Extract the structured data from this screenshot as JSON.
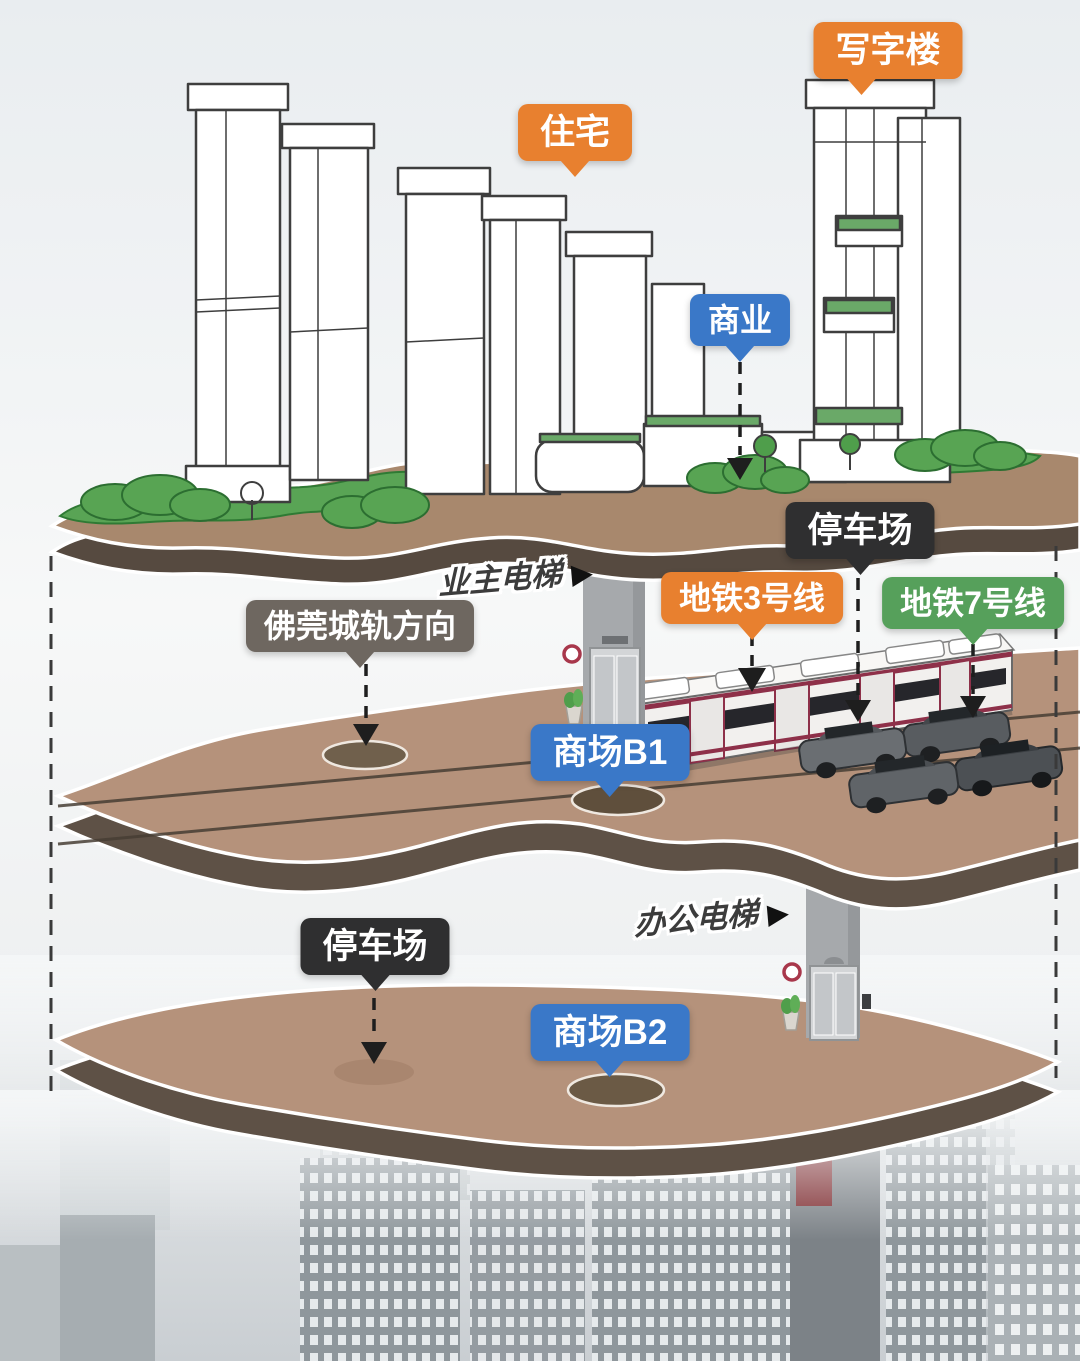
{
  "labels": {
    "office_tower": "写字楼",
    "residential": "住宅",
    "commercial": "商业",
    "parking_upper": "停车场",
    "metro_line3": "地铁3号线",
    "metro_line7": "地铁7号线",
    "intercity_rail_direction": "佛莞城轨方向",
    "owner_elevator": "业主电梯",
    "mall_b1": "商场B1",
    "office_elevator": "办公电梯",
    "parking_lower": "停车场",
    "mall_b2": "商场B2"
  },
  "icons": {
    "arrow_right": "▶"
  },
  "colors": {
    "orange": "#E8802F",
    "blue": "#3A78C8",
    "green": "#56A05B",
    "dark": "#2F2F30",
    "gray": "#6E6760",
    "slab_top": "#B5927B",
    "slab_edge": "#6E6055",
    "ground_top": "#A8886D",
    "grass": "#59A455"
  }
}
